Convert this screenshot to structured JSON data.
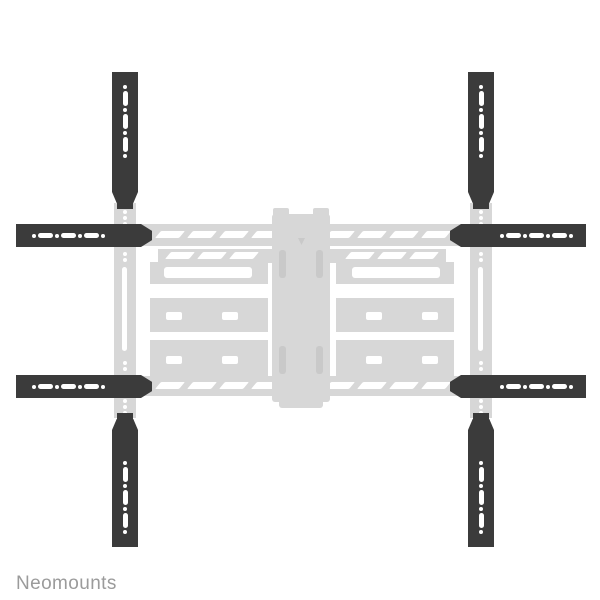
{
  "image": {
    "alt": "Black screen-extender brackets (four vertical, four horizontal) mounted on a faded light-gray full-motion TV wall mount, front view on white background"
  },
  "brand": {
    "logo_text": "Neomounts"
  },
  "colors": {
    "background": "#ffffff",
    "bar": "#3b3b3b",
    "mount": "#d7d7d7",
    "mount_detail": "#c9c9c9",
    "hole": "#ffffff",
    "logo": "#9b9b9b"
  }
}
